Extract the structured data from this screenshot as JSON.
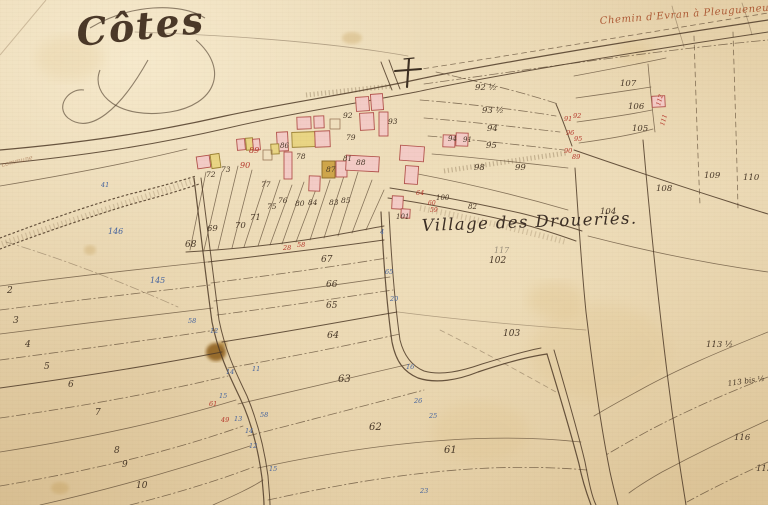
{
  "map": {
    "section_title": "Côtes",
    "road_label": "Chemin d'Evran à Pleugueneuc",
    "village_label": "Village des Droueries.",
    "margin_label": "commune",
    "colors": {
      "paper": "#e9d8b5",
      "boundary_ink": "#4f3b28",
      "number_ink": "#473727",
      "red_ink": "#b5372b",
      "blue_ink": "#44639e",
      "pencil": "#8a8070",
      "building_pink": "#f3cbc6",
      "building_yellow": "#e9d584",
      "building_tan": "#cfa64b",
      "title_ink": "#4a3828",
      "road_label_ink": "#a84f2a",
      "stain_brown": "#8a5a12"
    },
    "parcel_labels": [
      {
        "n": "2",
        "x": 7,
        "y": 293,
        "s": 9
      },
      {
        "n": "3",
        "x": 13,
        "y": 323,
        "s": 9
      },
      {
        "n": "4",
        "x": 25,
        "y": 347,
        "s": 9
      },
      {
        "n": "5",
        "x": 44,
        "y": 369,
        "s": 9
      },
      {
        "n": "6",
        "x": 68,
        "y": 387,
        "s": 9
      },
      {
        "n": "7",
        "x": 95,
        "y": 415,
        "s": 9
      },
      {
        "n": "8",
        "x": 114,
        "y": 453,
        "s": 9
      },
      {
        "n": "9",
        "x": 122,
        "y": 467,
        "s": 9
      },
      {
        "n": "10",
        "x": 136,
        "y": 488,
        "s": 9
      },
      {
        "n": "61",
        "x": 444,
        "y": 453,
        "s": 10
      },
      {
        "n": "62",
        "x": 369,
        "y": 430,
        "s": 10
      },
      {
        "n": "63",
        "x": 338,
        "y": 382,
        "s": 10
      },
      {
        "n": "64",
        "x": 327,
        "y": 338,
        "s": 9.5
      },
      {
        "n": "65",
        "x": 326,
        "y": 308,
        "s": 9
      },
      {
        "n": "66",
        "x": 326,
        "y": 287,
        "s": 9
      },
      {
        "n": "67",
        "x": 321,
        "y": 262,
        "s": 9
      },
      {
        "n": "68",
        "x": 185,
        "y": 247,
        "s": 9
      },
      {
        "n": "69",
        "x": 207,
        "y": 231
      },
      {
        "n": "70",
        "x": 235,
        "y": 228
      },
      {
        "n": "71",
        "x": 250,
        "y": 220
      },
      {
        "n": "72",
        "x": 206,
        "y": 177,
        "s": 7.5
      },
      {
        "n": "73",
        "x": 221,
        "y": 172,
        "s": 7.5
      },
      {
        "n": "75",
        "x": 267,
        "y": 209,
        "s": 7.5
      },
      {
        "n": "76",
        "x": 278,
        "y": 203,
        "s": 7.5
      },
      {
        "n": "77",
        "x": 261,
        "y": 187,
        "s": 7.5
      },
      {
        "n": "78",
        "x": 296,
        "y": 159,
        "s": 7.5
      },
      {
        "n": "79",
        "x": 346,
        "y": 140,
        "s": 7.5
      },
      {
        "n": "80",
        "x": 295,
        "y": 206,
        "s": 7.5
      },
      {
        "n": "81",
        "x": 343,
        "y": 161,
        "s": 7
      },
      {
        "n": "82",
        "x": 468,
        "y": 209,
        "s": 7
      },
      {
        "n": "83",
        "x": 329,
        "y": 205,
        "s": 7.5
      },
      {
        "n": "84",
        "x": 308,
        "y": 205,
        "s": 7.5
      },
      {
        "n": "85",
        "x": 341,
        "y": 203,
        "s": 7.5
      },
      {
        "n": "86",
        "x": 280,
        "y": 148,
        "s": 7
      },
      {
        "n": "87",
        "x": 326,
        "y": 172,
        "s": 7.5
      },
      {
        "n": "88",
        "x": 356,
        "y": 165,
        "s": 7.5
      },
      {
        "n": "91",
        "x": 463,
        "y": 142,
        "s": 7
      },
      {
        "n": "92",
        "x": 343,
        "y": 118,
        "s": 7.5
      },
      {
        "n": "93",
        "x": 388,
        "y": 124,
        "s": 7.5
      },
      {
        "n": "94",
        "x": 448,
        "y": 141,
        "s": 7
      },
      {
        "n": "92 ½",
        "x": 475,
        "y": 90,
        "s": 8.5
      },
      {
        "n": "93 ½",
        "x": 482,
        "y": 113,
        "s": 8.5
      },
      {
        "n": "94",
        "x": 487,
        "y": 131,
        "s": 8.5
      },
      {
        "n": "95",
        "x": 486,
        "y": 148,
        "s": 8.5
      },
      {
        "n": "98",
        "x": 474,
        "y": 170,
        "s": 8.5
      },
      {
        "n": "99",
        "x": 515,
        "y": 170,
        "s": 8.5
      },
      {
        "n": "100",
        "x": 436,
        "y": 200,
        "s": 7
      },
      {
        "n": "101",
        "x": 396,
        "y": 219,
        "s": 7
      },
      {
        "n": "102",
        "x": 489,
        "y": 263,
        "s": 9
      },
      {
        "n": "103",
        "x": 503,
        "y": 336,
        "s": 9
      },
      {
        "n": "104",
        "x": 600,
        "y": 214,
        "s": 8.5
      },
      {
        "n": "105",
        "x": 632,
        "y": 131,
        "s": 8.5
      },
      {
        "n": "106",
        "x": 628,
        "y": 109,
        "s": 8.5
      },
      {
        "n": "107",
        "x": 620,
        "y": 86,
        "s": 8.5
      },
      {
        "n": "108",
        "x": 656,
        "y": 191,
        "s": 8.5
      },
      {
        "n": "109",
        "x": 704,
        "y": 178,
        "s": 8.5
      },
      {
        "n": "110",
        "x": 743,
        "y": 180,
        "s": 8.5
      },
      {
        "n": "113 ½",
        "x": 706,
        "y": 347,
        "s": 8.5
      },
      {
        "n": "113 bis ½",
        "x": 728,
        "y": 386,
        "s": 7.5,
        "r": -8
      },
      {
        "n": "116",
        "x": 734,
        "y": 440,
        "s": 8.5
      },
      {
        "n": "115",
        "x": 756,
        "y": 471,
        "s": 8.5
      },
      {
        "n": "89",
        "x": 249,
        "y": 153,
        "c": "red",
        "s": 8
      },
      {
        "n": "90",
        "x": 240,
        "y": 168,
        "c": "red",
        "s": 8
      },
      {
        "n": "28",
        "x": 283,
        "y": 250,
        "c": "red",
        "s": 6.5
      },
      {
        "n": "58",
        "x": 297,
        "y": 247,
        "c": "red",
        "s": 6.5
      },
      {
        "n": "64",
        "x": 416,
        "y": 195,
        "c": "red",
        "s": 6.5
      },
      {
        "n": "60",
        "x": 428,
        "y": 205,
        "c": "red",
        "s": 6
      },
      {
        "n": "59",
        "x": 430,
        "y": 212,
        "c": "red",
        "s": 6
      },
      {
        "n": "91",
        "x": 564,
        "y": 121,
        "c": "red",
        "s": 6.5
      },
      {
        "n": "92",
        "x": 573,
        "y": 118,
        "c": "red",
        "s": 6.5
      },
      {
        "n": "96",
        "x": 566,
        "y": 135,
        "c": "red",
        "s": 6.5
      },
      {
        "n": "95",
        "x": 574,
        "y": 141,
        "c": "red",
        "s": 6.5
      },
      {
        "n": "90",
        "x": 564,
        "y": 153,
        "c": "red",
        "s": 6.5
      },
      {
        "n": "89",
        "x": 572,
        "y": 159,
        "c": "red",
        "s": 6.5
      },
      {
        "n": "112",
        "x": 660,
        "y": 106,
        "c": "red",
        "s": 6,
        "r": -75
      },
      {
        "n": "111",
        "x": 664,
        "y": 126,
        "c": "red",
        "s": 6,
        "r": -75
      },
      {
        "n": "61",
        "x": 209,
        "y": 406,
        "c": "red",
        "s": 6.5
      },
      {
        "n": "49",
        "x": 221,
        "y": 422,
        "c": "red",
        "s": 6.5
      },
      {
        "n": "146",
        "x": 108,
        "y": 234,
        "c": "blue",
        "s": 8
      },
      {
        "n": "145",
        "x": 150,
        "y": 283,
        "c": "blue",
        "s": 8
      },
      {
        "n": "41",
        "x": 101,
        "y": 187,
        "c": "blue",
        "s": 6.5
      },
      {
        "n": "58",
        "x": 188,
        "y": 323,
        "c": "blue",
        "s": 6.5
      },
      {
        "n": "12",
        "x": 210,
        "y": 333,
        "c": "blue",
        "s": 6.5
      },
      {
        "n": "14",
        "x": 226,
        "y": 374,
        "c": "blue",
        "s": 6.5
      },
      {
        "n": "11",
        "x": 252,
        "y": 371,
        "c": "blue",
        "s": 6.5
      },
      {
        "n": "15",
        "x": 219,
        "y": 398,
        "c": "blue",
        "s": 6.5
      },
      {
        "n": "13",
        "x": 234,
        "y": 421,
        "c": "blue",
        "s": 6.5
      },
      {
        "n": "58",
        "x": 260,
        "y": 417,
        "c": "blue",
        "s": 6.5
      },
      {
        "n": "14",
        "x": 245,
        "y": 433,
        "c": "blue",
        "s": 6.5
      },
      {
        "n": "12",
        "x": 249,
        "y": 448,
        "c": "blue",
        "s": 6.5
      },
      {
        "n": "15",
        "x": 269,
        "y": 471,
        "c": "blue",
        "s": 6.5
      },
      {
        "n": "4",
        "x": 380,
        "y": 234,
        "c": "blue",
        "s": 6.5
      },
      {
        "n": "65",
        "x": 385,
        "y": 274,
        "c": "blue",
        "s": 6.5
      },
      {
        "n": "20",
        "x": 390,
        "y": 301,
        "c": "blue",
        "s": 6.5
      },
      {
        "n": "16",
        "x": 406,
        "y": 369,
        "c": "blue",
        "s": 6.5
      },
      {
        "n": "26",
        "x": 414,
        "y": 403,
        "c": "blue",
        "s": 6.5
      },
      {
        "n": "25",
        "x": 429,
        "y": 418,
        "c": "blue",
        "s": 6.5
      },
      {
        "n": "23",
        "x": 420,
        "y": 493,
        "c": "blue",
        "s": 6.5
      },
      {
        "n": "117",
        "x": 494,
        "y": 253,
        "c": "pencil",
        "s": 8
      }
    ],
    "buildings": [
      {
        "x": 197,
        "y": 156,
        "w": 13,
        "h": 12,
        "r": -8,
        "t": "pink"
      },
      {
        "x": 211,
        "y": 154,
        "w": 9,
        "h": 14,
        "r": -8,
        "t": "yellow"
      },
      {
        "x": 237,
        "y": 139,
        "w": 8,
        "h": 11,
        "r": -5,
        "t": "pink"
      },
      {
        "x": 246,
        "y": 138,
        "w": 7,
        "h": 12,
        "r": -5,
        "t": "yellow"
      },
      {
        "x": 253,
        "y": 139,
        "w": 7,
        "h": 11,
        "r": -5,
        "t": "pink"
      },
      {
        "x": 277,
        "y": 132,
        "w": 11,
        "h": 19,
        "r": -3,
        "t": "pink"
      },
      {
        "x": 271,
        "y": 144,
        "w": 8,
        "h": 10,
        "r": -3,
        "t": "yellow"
      },
      {
        "x": 292,
        "y": 132,
        "w": 23,
        "h": 15,
        "r": -2,
        "t": "yellow"
      },
      {
        "x": 315,
        "y": 131,
        "w": 15,
        "h": 16,
        "r": -2,
        "t": "pink"
      },
      {
        "x": 297,
        "y": 117,
        "w": 14,
        "h": 12,
        "r": -2,
        "t": "pink"
      },
      {
        "x": 314,
        "y": 116,
        "w": 10,
        "h": 12,
        "r": -2,
        "t": "pink"
      },
      {
        "x": 284,
        "y": 152,
        "w": 8,
        "h": 27,
        "r": 0,
        "t": "pink"
      },
      {
        "x": 309,
        "y": 176,
        "w": 11,
        "h": 15,
        "r": 2,
        "t": "pink"
      },
      {
        "x": 322,
        "y": 161,
        "w": 13,
        "h": 17,
        "r": 0,
        "t": "tan"
      },
      {
        "x": 336,
        "y": 161,
        "w": 11,
        "h": 16,
        "r": 0,
        "t": "pink"
      },
      {
        "x": 346,
        "y": 156,
        "w": 33,
        "h": 15,
        "r": 3,
        "t": "pink"
      },
      {
        "x": 356,
        "y": 97,
        "w": 13,
        "h": 14,
        "r": -4,
        "t": "pink"
      },
      {
        "x": 371,
        "y": 94,
        "w": 12,
        "h": 16,
        "r": -4,
        "t": "pink"
      },
      {
        "x": 379,
        "y": 112,
        "w": 9,
        "h": 24,
        "r": 0,
        "t": "pink"
      },
      {
        "x": 360,
        "y": 113,
        "w": 14,
        "h": 17,
        "r": -3,
        "t": "pink"
      },
      {
        "x": 400,
        "y": 146,
        "w": 24,
        "h": 15,
        "r": 4,
        "t": "pink"
      },
      {
        "x": 405,
        "y": 166,
        "w": 13,
        "h": 18,
        "r": 4,
        "t": "pink"
      },
      {
        "x": 443,
        "y": 135,
        "w": 12,
        "h": 12,
        "r": 2,
        "t": "pink"
      },
      {
        "x": 456,
        "y": 133,
        "w": 12,
        "h": 13,
        "r": 2,
        "t": "pink"
      },
      {
        "x": 392,
        "y": 196,
        "w": 11,
        "h": 13,
        "r": 3,
        "t": "pink"
      },
      {
        "x": 401,
        "y": 209,
        "w": 9,
        "h": 9,
        "r": 3,
        "t": "pink"
      },
      {
        "x": 652,
        "y": 96,
        "w": 13,
        "h": 11,
        "r": -3,
        "t": "pink"
      },
      {
        "x": 263,
        "y": 150,
        "w": 9,
        "h": 10,
        "r": 0,
        "t": "open"
      },
      {
        "x": 330,
        "y": 119,
        "w": 10,
        "h": 10,
        "r": 0,
        "t": "open"
      }
    ]
  }
}
